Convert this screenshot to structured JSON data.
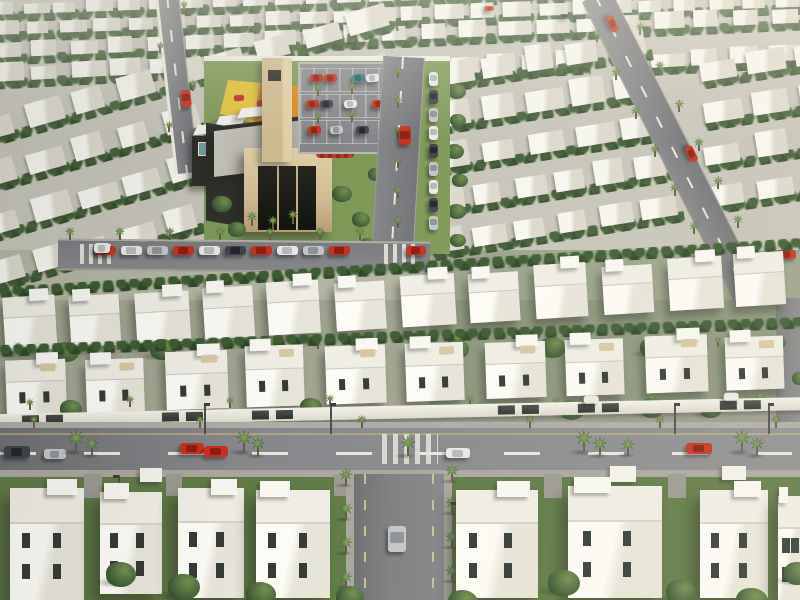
{
  "scene": {
    "kind": "3d-aerial-render",
    "subject": "master-planned white villa community with mosque, playground, parking lot and palm-lined streets",
    "w": 800,
    "h": 600,
    "palette": {
      "ground": "#c7c5ba",
      "lawn": "#607b45",
      "house": "#f4f3ed",
      "window": "#343b37",
      "road": "#7e7f82",
      "sidewalk": "#aeaca3",
      "dash": "#e9e8e0",
      "yellowLine": "rgba(205,190,120,0.55)",
      "wall": "#eeece2",
      "gateDark": "#3c3f3e",
      "treeGreen": "#47663a",
      "palmGreen": "#41663a",
      "trunk": "#6e5b44",
      "stone": "#d3bd92",
      "stoneLight": "#e4d1a8",
      "darkWall": "#2e2e29",
      "glass": "#6f9f9b",
      "roofGray": "#b5b2a9",
      "playYellow": "#e6c33c",
      "playOrange": "#dd8a21",
      "playRed": "#b83425",
      "flowerRed": "#b5402a"
    }
  },
  "seed": 7,
  "carColors": {
    "red": [
      "#c9311f",
      "#8e1d10"
    ],
    "white": [
      "#e9e9e5",
      "#b6b9ba"
    ],
    "dark": [
      "#41454b",
      "#23262b"
    ],
    "silver": [
      "#c3c6c9",
      "#8f9397"
    ],
    "teal": [
      "#3f7f82",
      "#2a5a5e"
    ]
  },
  "groundBands": [
    [
      0,
      0,
      800,
      262,
      "#c7c5ba"
    ],
    [
      0,
      250,
      800,
      62,
      "#b4b6a3"
    ],
    [
      0,
      300,
      800,
      128,
      "#a2a691"
    ],
    [
      430,
      250,
      370,
      175,
      "rgba(70,100,55,0.22)"
    ],
    [
      0,
      412,
      800,
      64,
      "#99998f"
    ],
    [
      0,
      470,
      800,
      130,
      "#607b45"
    ]
  ],
  "topRows": [
    [
      -10,
      2,
      820,
      13,
      26,
      -2
    ],
    [
      -10,
      20,
      820,
      15,
      24,
      -2
    ],
    [
      -10,
      41,
      820,
      17,
      21,
      -2.5
    ],
    [
      -10,
      64,
      200,
      18,
      5,
      -3
    ],
    [
      450,
      56,
      140,
      18,
      4,
      -3
    ],
    [
      648,
      50,
      160,
      18,
      4,
      -3
    ]
  ],
  "upperLeftStrips": [
    [
      -20,
      118,
      430,
      24,
      9,
      -16
    ],
    [
      -20,
      165,
      430,
      24,
      9,
      -16
    ],
    [
      -15,
      213,
      430,
      24,
      9,
      -16
    ],
    [
      -10,
      262,
      360,
      24,
      8,
      -16
    ]
  ],
  "upperRightStrips": [
    [
      438,
      60,
      215,
      26,
      5,
      -9
    ],
    [
      436,
      102,
      225,
      26,
      5,
      -9
    ],
    [
      434,
      144,
      235,
      26,
      5,
      -9
    ],
    [
      432,
      186,
      245,
      26,
      6,
      -9
    ],
    [
      430,
      228,
      255,
      26,
      6,
      -9
    ],
    [
      700,
      58,
      140,
      24,
      3,
      -9
    ],
    [
      702,
      100,
      145,
      24,
      3,
      -9
    ],
    [
      704,
      142,
      150,
      24,
      3,
      -9
    ],
    [
      706,
      184,
      150,
      24,
      3,
      -9
    ]
  ],
  "bandC": {
    "rot": -3.5,
    "x": 0,
    "y": 300,
    "h": 52,
    "villas": [
      [
        4,
        52
      ],
      [
        70,
        50
      ],
      [
        136,
        54
      ],
      [
        204,
        50
      ],
      [
        268,
        52
      ],
      [
        336,
        50
      ],
      [
        402,
        54
      ],
      [
        470,
        50
      ],
      [
        536,
        52
      ],
      [
        604,
        50
      ],
      [
        670,
        54
      ],
      [
        736,
        50
      ]
    ]
  },
  "bandD": {
    "rot": -2,
    "x": 0,
    "y": 358,
    "h": 58,
    "villas": [
      [
        6,
        60
      ],
      [
        86,
        58
      ],
      [
        166,
        62
      ],
      [
        246,
        58
      ],
      [
        326,
        60
      ],
      [
        406,
        58
      ],
      [
        486,
        60
      ],
      [
        566,
        58
      ],
      [
        646,
        62
      ],
      [
        726,
        58
      ]
    ]
  },
  "community": {
    "lawn": [
      204,
      58,
      246,
      196
    ],
    "wallTop": [
      204,
      56,
      246,
      5
    ],
    "playground": {
      "x": 220,
      "y": 80,
      "w": 100,
      "h": 58,
      "clip": "polygon(8% 0,100% 14%,86% 100%,0 58%)",
      "split": 36
    },
    "playEquip": [
      [
        234,
        95,
        10,
        6
      ],
      [
        257,
        100,
        12,
        7
      ],
      [
        281,
        92,
        9,
        6
      ]
    ],
    "canopies": [
      [
        196,
        124,
        26,
        10
      ],
      [
        218,
        115,
        26,
        10
      ],
      [
        240,
        107,
        26,
        10
      ]
    ],
    "annex": [
      192,
      136,
      58,
      50
    ],
    "glass": [
      198,
      142,
      42,
      12
    ],
    "wing": [
      206,
      126,
      40,
      98
    ],
    "roofP": [
      214,
      120,
      114,
      46
    ],
    "facade": [
      244,
      148,
      88,
      84
    ],
    "door": [
      258,
      166,
      58,
      64
    ],
    "tower": [
      262,
      58,
      30,
      104
    ],
    "towerSlot": [
      268,
      70,
      13,
      11
    ],
    "frontPalms": [
      [
        252,
        226
      ],
      [
        273,
        230
      ],
      [
        293,
        224
      ]
    ],
    "flowerHedge": [
      316,
      146,
      38,
      12
    ],
    "lawnTrees": [
      [
        212,
        196,
        20
      ],
      [
        228,
        222,
        18
      ],
      [
        332,
        186,
        20
      ],
      [
        352,
        212,
        18
      ],
      [
        368,
        168,
        16
      ],
      [
        214,
        244,
        18
      ],
      [
        360,
        238,
        16
      ]
    ]
  },
  "parking": {
    "rect": [
      298,
      62,
      104,
      88
    ],
    "rows": [
      {
        "y": 68,
        "cars": [
          [
            310,
            "red"
          ],
          [
            324,
            "red"
          ],
          [
            352,
            "teal"
          ],
          [
            366,
            "white"
          ]
        ]
      },
      {
        "y": 94,
        "cars": [
          [
            306,
            "red"
          ],
          [
            320,
            "dark"
          ],
          [
            344,
            "white"
          ],
          [
            372,
            "red"
          ]
        ]
      },
      {
        "y": 120,
        "cars": [
          [
            308,
            "red"
          ],
          [
            330,
            "silver"
          ],
          [
            356,
            "dark"
          ],
          [
            382,
            "red"
          ]
        ]
      }
    ],
    "palms": [
      [
        318,
        96
      ],
      [
        352,
        94
      ],
      [
        318,
        124
      ],
      [
        352,
        122
      ],
      [
        386,
        122
      ]
    ]
  },
  "streetA": {
    "line": [
      404,
      56,
      392,
      262,
      40
    ],
    "parkedX": 429,
    "parkedYs": [
      72,
      90,
      108,
      126,
      144,
      162,
      180,
      198,
      216
    ],
    "parkedColors": [
      "white",
      "dark",
      "silver"
    ],
    "palmX": 398,
    "palmYs": [
      78,
      108,
      138,
      168,
      198,
      228
    ],
    "car": [
      399,
      126,
      12,
      19,
      "red"
    ]
  },
  "streetC": {
    "line": [
      168,
      -5,
      188,
      172,
      20
    ],
    "car": [
      181,
      90,
      10,
      17,
      "red"
    ],
    "palmYs": [
      18,
      55,
      95,
      132,
      160
    ]
  },
  "roadB": {
    "line": [
      596,
      -6,
      752,
      302,
      30
    ],
    "cars": [
      [
        604,
        20
      ],
      [
        683,
        150
      ],
      [
        734,
        248
      ]
    ],
    "palmN": 7,
    "palmOff": 21
  },
  "edgeRoad": [
    776,
    298,
    26,
    132
  ],
  "edgeRoadCar": [
    776,
    250,
    20,
    9,
    "red"
  ],
  "tinyCars": [
    [
      484,
      6,
      10,
      5,
      "red"
    ],
    [
      560,
      14,
      9,
      4,
      "dark"
    ]
  ],
  "treesCol": [
    [
      448,
      84,
      18
    ],
    [
      450,
      114,
      16
    ],
    [
      446,
      144,
      18
    ],
    [
      452,
      174,
      16
    ],
    [
      448,
      204,
      18
    ],
    [
      450,
      234,
      16
    ],
    [
      770,
      336,
      16
    ],
    [
      792,
      372,
      16
    ]
  ],
  "parkedStreet": {
    "rect": [
      58,
      240,
      372,
      28
    ],
    "rot": 0.5,
    "carY": 246,
    "cars": [
      [
        95,
        "red"
      ],
      [
        121,
        "white"
      ],
      [
        147,
        "silver"
      ],
      [
        173,
        "red"
      ],
      [
        199,
        "white"
      ],
      [
        225,
        "dark"
      ],
      [
        251,
        "red"
      ],
      [
        277,
        "white"
      ],
      [
        303,
        "silver"
      ],
      [
        329,
        "red"
      ]
    ],
    "van": [
      94,
      243,
      16,
      10,
      "white"
    ],
    "redCar": [
      406,
      246,
      20,
      9,
      "red"
    ],
    "crosswalks": [
      [
        80,
        34
      ],
      [
        384,
        34
      ]
    ],
    "palmXs": [
      70,
      120,
      170,
      220,
      270,
      320,
      360
    ],
    "palmY": 240
  },
  "bandCPalms": [
    [
      18,
      352
    ],
    [
      118,
      350
    ],
    [
      218,
      351
    ],
    [
      318,
      349
    ],
    [
      418,
      350
    ],
    [
      518,
      348
    ],
    [
      618,
      349
    ],
    [
      718,
      347
    ]
  ],
  "bandDPalms": [
    [
      30,
      410
    ],
    [
      130,
      407
    ],
    [
      230,
      408
    ],
    [
      330,
      406
    ],
    [
      470,
      406
    ],
    [
      556,
      408
    ],
    [
      652,
      406
    ],
    [
      760,
      404
    ]
  ],
  "treesMid": [
    [
      55,
      342,
      24
    ],
    [
      150,
      339,
      26
    ],
    [
      255,
      341,
      24
    ],
    [
      350,
      338,
      26
    ],
    [
      445,
      339,
      24
    ],
    [
      540,
      337,
      26
    ],
    [
      640,
      338,
      24
    ],
    [
      735,
      336,
      26
    ]
  ],
  "treesWall": [
    [
      60,
      400,
      22
    ],
    [
      300,
      398,
      22
    ],
    [
      560,
      400,
      24
    ],
    [
      640,
      398,
      24
    ],
    [
      700,
      400,
      22
    ]
  ],
  "wall": {
    "y": 414,
    "h": 13,
    "rot": -1.2,
    "gates": [
      22,
      46,
      162,
      186,
      252,
      276,
      498,
      522,
      578,
      602,
      720,
      744
    ],
    "carHints": [
      584,
      724
    ]
  },
  "mainRoad": {
    "y": 428,
    "h": 42,
    "dashY": 452,
    "zebra": [
      382,
      56
    ],
    "cars": [
      [
        4,
        446,
        26,
        12,
        "dark"
      ],
      [
        44,
        449,
        22,
        10,
        "silver"
      ],
      [
        180,
        443,
        24,
        11,
        "red"
      ],
      [
        204,
        446,
        24,
        11,
        "red"
      ],
      [
        446,
        448,
        24,
        10,
        "white"
      ],
      [
        686,
        443,
        26,
        11,
        "red"
      ]
    ],
    "lampsTop": [
      204,
      330,
      674,
      768
    ],
    "lampsBottom": [
      118,
      475
    ],
    "palmsFar": [
      34,
      200,
      362,
      530,
      660,
      776
    ]
  },
  "fgPalms": [
    [
      76,
      452,
      15
    ],
    [
      92,
      456,
      13
    ],
    [
      244,
      452,
      15
    ],
    [
      258,
      456,
      13
    ],
    [
      408,
      456,
      14
    ],
    [
      584,
      452,
      15
    ],
    [
      600,
      456,
      13
    ],
    [
      628,
      456,
      12
    ],
    [
      742,
      452,
      15
    ],
    [
      757,
      456,
      13
    ]
  ],
  "vertStreet": {
    "x": 354,
    "y": 474,
    "w": 90,
    "h": 126,
    "car": [
      388,
      526,
      18,
      26,
      "silver"
    ],
    "palmsL": {
      "x": 346,
      "ys": [
        486,
        520,
        554,
        588
      ],
      "s": 12
    },
    "palmsR": {
      "x": 452,
      "ys": [
        482,
        514,
        548,
        582
      ],
      "s": 12
    },
    "lamp": [
      456,
      502
    ]
  },
  "gateBoxes": [
    [
      140,
      468,
      22,
      14
    ],
    [
      610,
      466,
      26,
      16
    ],
    [
      722,
      466,
      24,
      14
    ]
  ],
  "driveways": [
    [
      84,
      474,
      18,
      24
    ],
    [
      166,
      474,
      16,
      22
    ],
    [
      334,
      474,
      16,
      22
    ],
    [
      544,
      474,
      18,
      24
    ],
    [
      668,
      474,
      18,
      24
    ]
  ],
  "fgVillas": [
    [
      10,
      488,
      74,
      112
    ],
    [
      100,
      492,
      62,
      102
    ],
    [
      178,
      488,
      66,
      110
    ],
    [
      256,
      490,
      74,
      108
    ],
    [
      456,
      490,
      82,
      108
    ],
    [
      568,
      486,
      94,
      112
    ],
    [
      700,
      490,
      68,
      108
    ],
    [
      778,
      496,
      22,
      104
    ]
  ],
  "treesFg": [
    [
      106,
      562,
      30
    ],
    [
      168,
      574,
      32
    ],
    [
      246,
      582,
      30
    ],
    [
      336,
      586,
      28
    ],
    [
      448,
      590,
      30
    ],
    [
      548,
      570,
      32
    ],
    [
      666,
      580,
      30
    ],
    [
      736,
      588,
      32
    ],
    [
      784,
      562,
      28
    ]
  ]
}
